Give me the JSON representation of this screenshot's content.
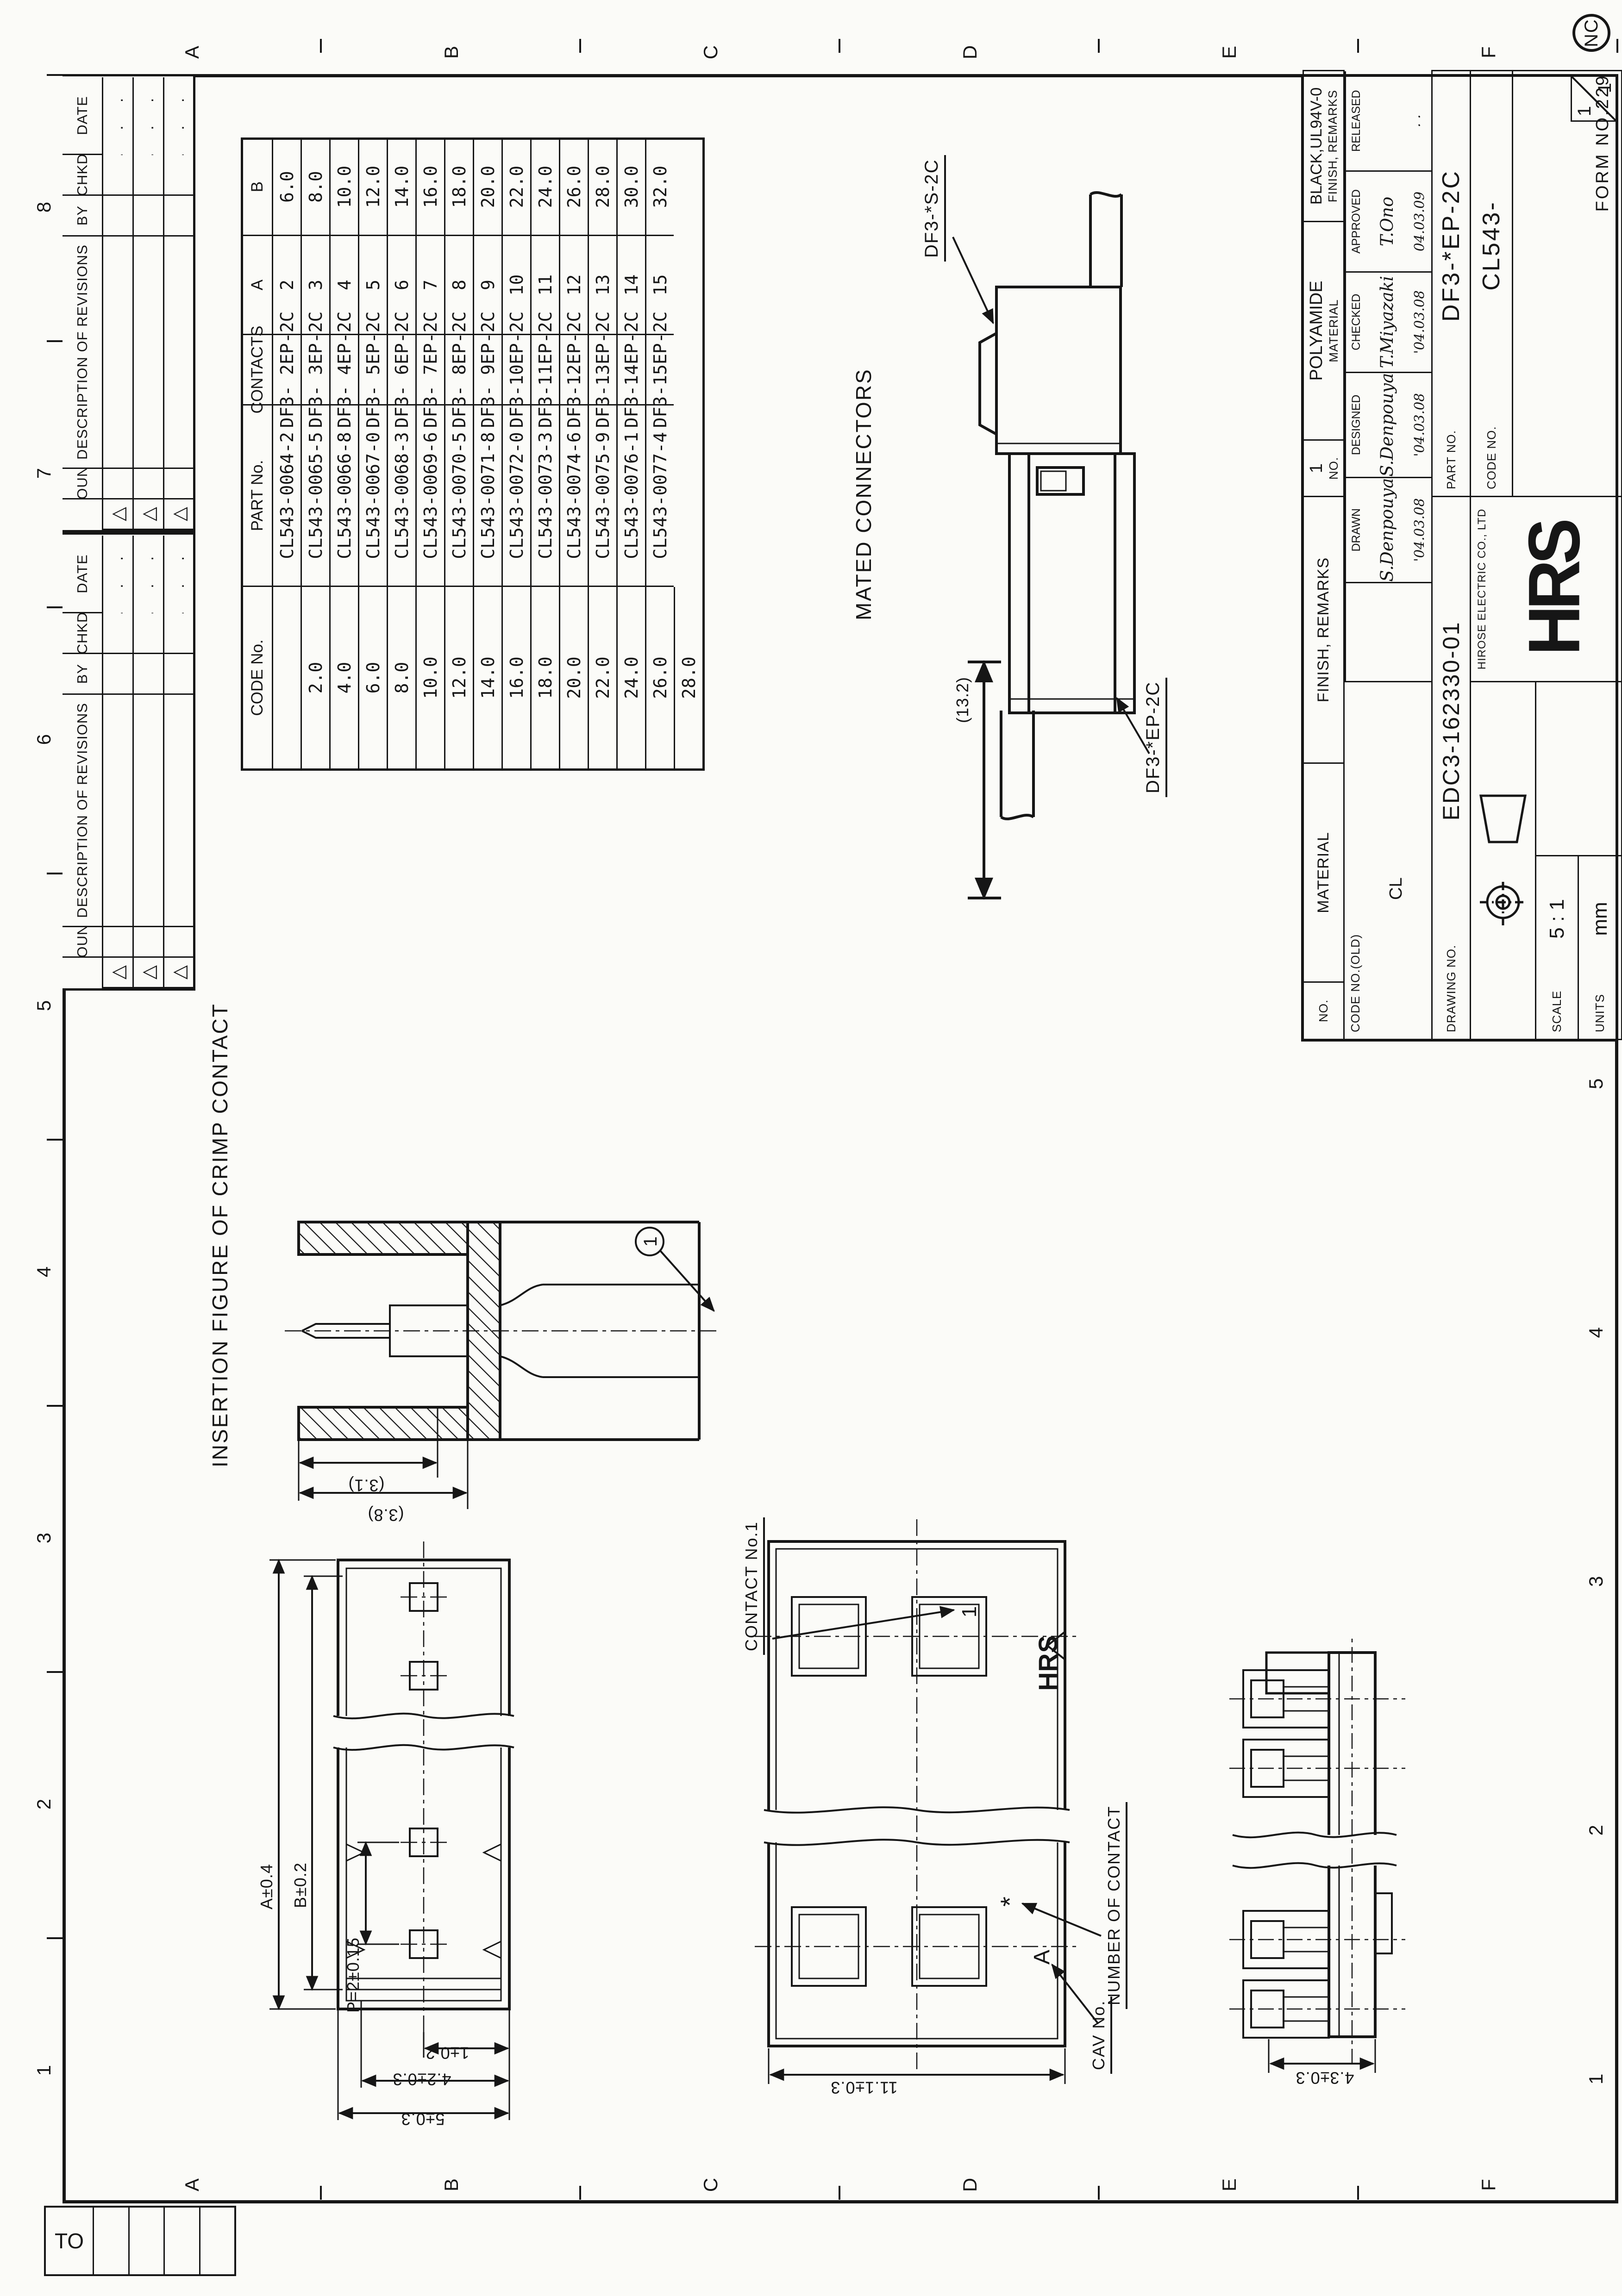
{
  "sheet": {
    "form_no": "FORM NO.229",
    "stamp": "NC",
    "sheet_no": {
      "left": "1",
      "right": "1"
    },
    "zone_numbers": [
      "1",
      "2",
      "3",
      "4",
      "5",
      "6",
      "7",
      "8"
    ],
    "zone_letters": [
      "A",
      "B",
      "C",
      "D",
      "E",
      "F"
    ]
  },
  "to_block": {
    "label": "TO"
  },
  "revision_table": {
    "headers": {
      "count": "COUNT",
      "description": "DESCRIPTION OF REVISIONS",
      "by": "BY",
      "chkd": "CHKD",
      "date": "DATE"
    },
    "rows": [
      {
        "mark": "△",
        "date": "..."
      },
      {
        "mark": "△",
        "date": "..."
      },
      {
        "mark": "△",
        "date": "..."
      }
    ]
  },
  "parts_table": {
    "headers": {
      "code": "CODE No.",
      "part": "PART No.",
      "contacts": "CONTACTS",
      "a": "A",
      "b": "B"
    },
    "rows": [
      {
        "code": "CL543-0064-2",
        "part": "DF3- 2EP-2C",
        "contacts": "2",
        "a": "6.0",
        "b": "2.0"
      },
      {
        "code": "CL543-0065-5",
        "part": "DF3- 3EP-2C",
        "contacts": "3",
        "a": "8.0",
        "b": "4.0"
      },
      {
        "code": "CL543-0066-8",
        "part": "DF3- 4EP-2C",
        "contacts": "4",
        "a": "10.0",
        "b": "6.0"
      },
      {
        "code": "CL543-0067-0",
        "part": "DF3- 5EP-2C",
        "contacts": "5",
        "a": "12.0",
        "b": "8.0"
      },
      {
        "code": "CL543-0068-3",
        "part": "DF3- 6EP-2C",
        "contacts": "6",
        "a": "14.0",
        "b": "10.0"
      },
      {
        "code": "CL543-0069-6",
        "part": "DF3- 7EP-2C",
        "contacts": "7",
        "a": "16.0",
        "b": "12.0"
      },
      {
        "code": "CL543-0070-5",
        "part": "DF3- 8EP-2C",
        "contacts": "8",
        "a": "18.0",
        "b": "14.0"
      },
      {
        "code": "CL543-0071-8",
        "part": "DF3- 9EP-2C",
        "contacts": "9",
        "a": "20.0",
        "b": "16.0"
      },
      {
        "code": "CL543-0072-0",
        "part": "DF3-10EP-2C",
        "contacts": "10",
        "a": "22.0",
        "b": "18.0"
      },
      {
        "code": "CL543-0073-3",
        "part": "DF3-11EP-2C",
        "contacts": "11",
        "a": "24.0",
        "b": "20.0"
      },
      {
        "code": "CL543-0074-6",
        "part": "DF3-12EP-2C",
        "contacts": "12",
        "a": "26.0",
        "b": "22.0"
      },
      {
        "code": "CL543-0075-9",
        "part": "DF3-13EP-2C",
        "contacts": "13",
        "a": "28.0",
        "b": "24.0"
      },
      {
        "code": "CL543-0076-1",
        "part": "DF3-14EP-2C",
        "contacts": "14",
        "a": "30.0",
        "b": "26.0"
      },
      {
        "code": "CL543-0077-4",
        "part": "DF3-15EP-2C",
        "contacts": "15",
        "a": "32.0",
        "b": "28.0"
      }
    ]
  },
  "title_block": {
    "material": {
      "no_label": "NO.",
      "material_label": "MATERIAL",
      "finish_label": "FINISH, REMARKS",
      "no": "1",
      "material": "POLYAMIDE",
      "finish": "BLACK,UL94V-0"
    },
    "code_no_old": {
      "label": "CODE NO.(OLD)",
      "value": "CL"
    },
    "signatures": [
      {
        "label": "DRAWN",
        "name": "S.Denpouya",
        "date": "'04.03.08"
      },
      {
        "label": "DESIGNED",
        "name": "S.Denpouya",
        "date": "'04.03.08"
      },
      {
        "label": "CHECKED",
        "name": "T.Miyazaki",
        "date": "'04.03.08"
      },
      {
        "label": "APPROVED",
        "name": "T.Ono",
        "date": "04.03.09"
      },
      {
        "label": "RELEASED",
        "name": "",
        "date": "· ·"
      }
    ],
    "drawing_no": {
      "label": "DRAWING NO.",
      "value": "EDC3-162330-01"
    },
    "part_no": {
      "label": "PART NO.",
      "value": "DF3-*EP-2C"
    },
    "code_no": {
      "label": "CODE NO.",
      "value": "CL543-"
    },
    "scale": {
      "label": "SCALE",
      "value": "5 : 1"
    },
    "units": {
      "label": "UNITS",
      "value": "mm"
    },
    "company": "HIROSE ELECTRIC CO., LTD",
    "logo": "HRS"
  },
  "figures": {
    "mated": {
      "title": "MATED CONNECTORS",
      "dim_height": "(13.2)",
      "label_socket": "DF3-*S-2C",
      "label_plug": "DF3-*EP-2C"
    },
    "insertion": {
      "title": "INSERTION FIGURE OF CRIMP CONTACT",
      "dim_inner": "(3.1)",
      "dim_outer": "(3.8)",
      "balloon": "1"
    },
    "top_view": {
      "dim_a": "A±0.4",
      "dim_b": "B±0.2",
      "dim_p": "P=2±0.15",
      "dim_end1": "1±0.2",
      "dim_end42": "4.2±0.3",
      "dim_end5": "5±0.3"
    },
    "face_view": {
      "contact_no1": "CONTACT No.1",
      "number_of_contact": "NUMBER OF CONTACT",
      "cav_no": "CAV No.",
      "dim_width": "11.1±0.3",
      "cavity1": "1",
      "asterisk": "*",
      "mark_a": "A",
      "molded_logo": "HRS"
    },
    "side_view": {
      "dim": "4.3±0.3"
    }
  }
}
